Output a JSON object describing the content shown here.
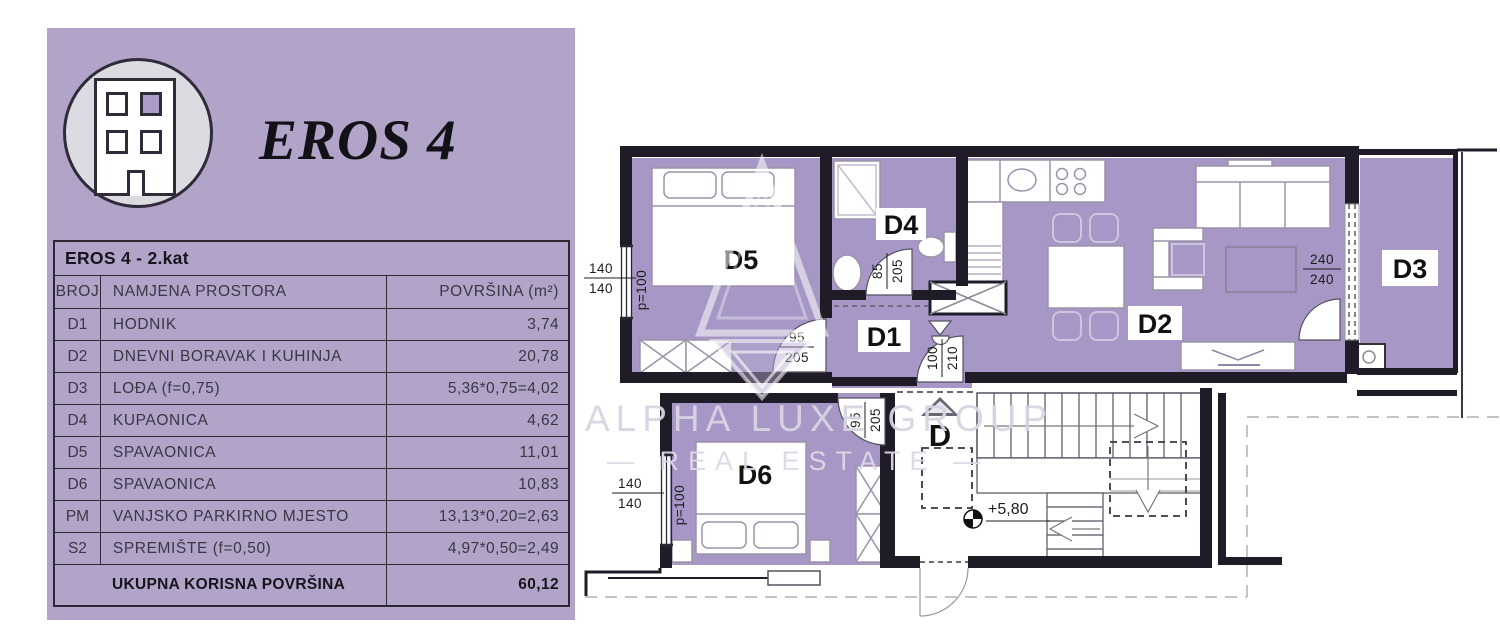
{
  "panel": {
    "title": "EROS 4",
    "table": {
      "caption": "EROS 4 - 2.kat",
      "columns": [
        "BROJ",
        "NAMJENA PROSTORA",
        "POVRŠINA (m²)"
      ],
      "rows": [
        {
          "id": "D1",
          "name": "HODNIK",
          "area": "3,74"
        },
        {
          "id": "D2",
          "name": "DNEVNI BORAVAK I KUHINJA",
          "area": "20,78"
        },
        {
          "id": "D3",
          "name": "LOĐA (f=0,75)",
          "area": "5,36*0,75=4,02"
        },
        {
          "id": "D4",
          "name": "KUPAONICA",
          "area": "4,62"
        },
        {
          "id": "D5",
          "name": "SPAVAONICA",
          "area": "11,01"
        },
        {
          "id": "D6",
          "name": "SPAVAONICA",
          "area": "10,83"
        },
        {
          "id": "PM",
          "name": "VANJSKO PARKIRNO MJESTO",
          "area": "13,13*0,20=2,63"
        },
        {
          "id": "S2",
          "name": "SPREMIŠTE (f=0,50)",
          "area": "4,97*0,50=2,49"
        }
      ],
      "total_label": "UKUPNA KORISNA POVRŠINA",
      "total_value": "60,12"
    }
  },
  "plan": {
    "room_labels": {
      "d1": "D1",
      "d2": "D2",
      "d3": "D3",
      "d4": "D4",
      "d5": "D5",
      "d6": "D6",
      "stair": "D"
    },
    "level_mark": "+5,80",
    "dims": {
      "d5_window_top": "140",
      "d5_window_bot": "140",
      "d5_p": "p=100",
      "d5_door_top": "95",
      "d5_door_bot": "205",
      "d4_door_top": "85",
      "d4_door_bot": "205",
      "entry_door_top": "100",
      "entry_door_bot": "210",
      "d3_door_top": "240",
      "d3_door_bot": "240",
      "d6_door_top": "95",
      "d6_door_bot": "205",
      "d6_window_top": "140",
      "d6_window_bot": "140",
      "d6_p": "p=100"
    },
    "watermark": {
      "line1": "ALPHA LUXE GROUP",
      "line2": "— REAL ESTATE —"
    }
  },
  "colors": {
    "panel_bg": "#b1a4c8",
    "room_fill": "#a697c6",
    "wall": "#1f1c28"
  }
}
